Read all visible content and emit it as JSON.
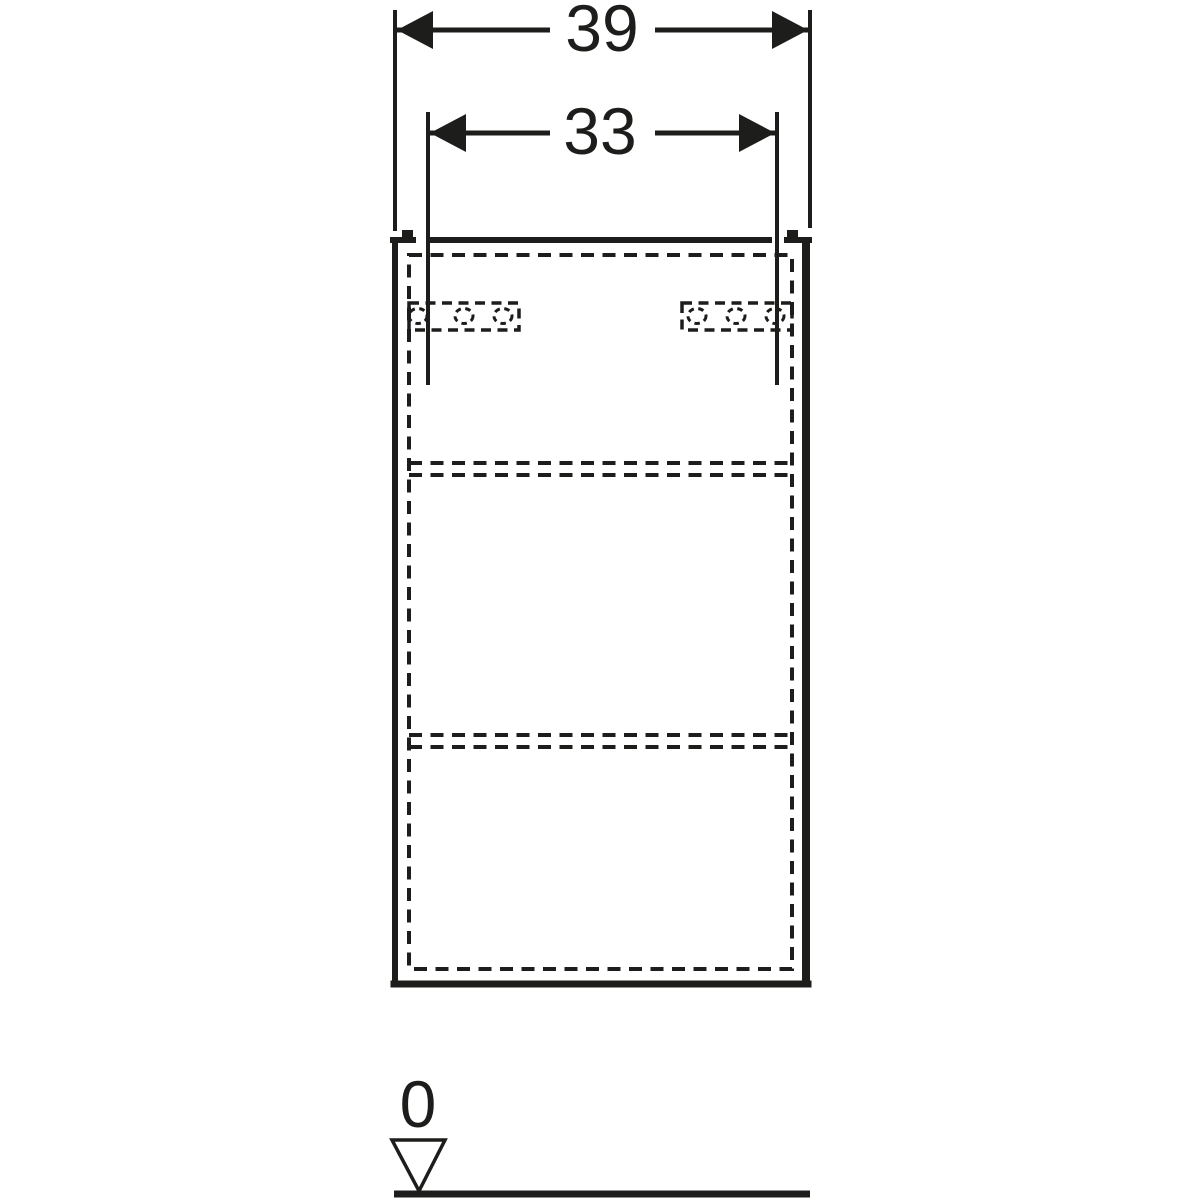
{
  "drawing": {
    "description": "Front-view dimensional technical drawing of a wall-hung cabinet: outer width dimension, mounting-bracket spacing dimension, dashed hidden lines for back panel, two shelves and two bracket plates with slotted holes, and a floor datum mark",
    "line_color": "#1d1d1b",
    "background_color": "#ffffff",
    "dimensions": {
      "outer_width": {
        "label": "39"
      },
      "bracket_spacing": {
        "label": "33"
      },
      "floor_datum": {
        "label": "0"
      }
    }
  }
}
